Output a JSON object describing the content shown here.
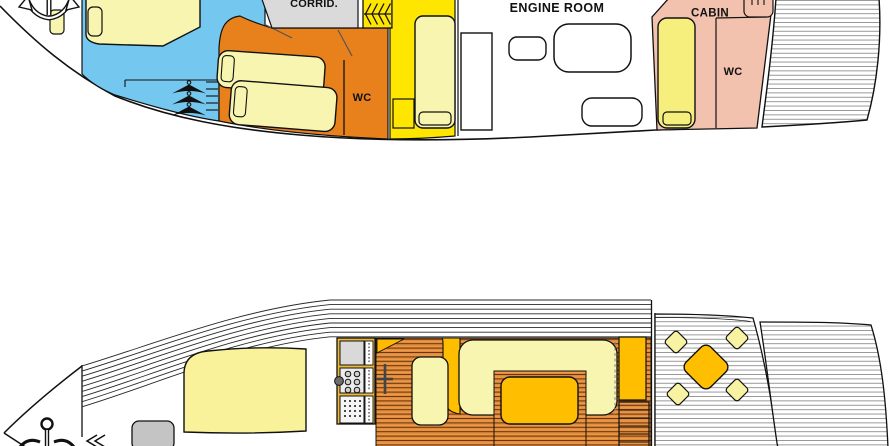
{
  "diagram": {
    "type": "yacht-deck-floor-plans",
    "plans": {
      "lower_deck": {
        "description": "below-deck cabin plan (top drawing, partially cropped at top)",
        "labels": {
          "corridor": "CORRID.",
          "engine_room": "ENGINE ROOM",
          "cabin": "CABIN",
          "wc_mid": "WC",
          "wc_aft": "WC"
        },
        "icons": {
          "bow": "anchor-icon",
          "wardrobe": "clothes-hanger-icon",
          "stairs": "companionway-stairs-icon"
        }
      },
      "main_deck": {
        "description": "main deck / salon plan (bottom drawing, partially cropped at bottom)",
        "labels": {},
        "icons": {
          "bow": "anchor-icon",
          "galley": "stove-burners-icon",
          "cockpit": "table-and-chairs-icon"
        }
      }
    },
    "colors": {
      "fore_cabin_blue": "#74C7EE",
      "mid_cabin_orange": "#E8811C",
      "stair_yellow": "#FFE600",
      "bed_cream": "#F8F5B0",
      "aft_cabin_pink": "#F3C2AF",
      "corridor_gray": "#DADADA",
      "amber_furniture": "#FFBE00",
      "wood_floor": "#E28C3C",
      "hatch_gray": "#C4C4C4",
      "outline": "#111111"
    }
  }
}
